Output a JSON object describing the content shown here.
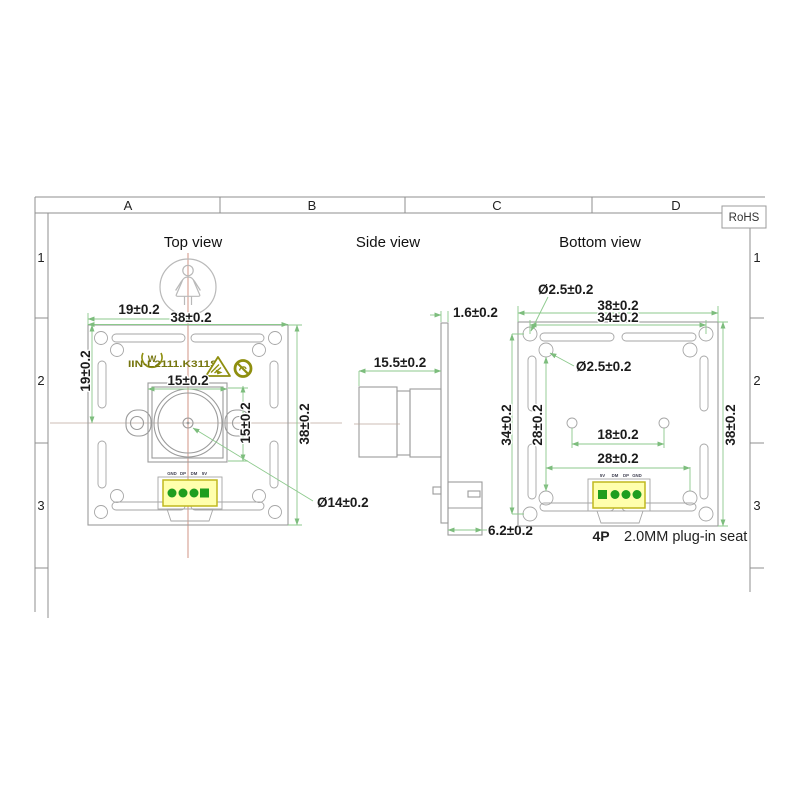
{
  "frame": {
    "columns": [
      "A",
      "B",
      "C",
      "D"
    ],
    "rows": [
      "1",
      "2",
      "3"
    ],
    "rohs": "RoHS"
  },
  "top_view": {
    "title": "Top view",
    "board_marking": "IIN-L2111.K311S",
    "pins": [
      "GND",
      "DP",
      "DM",
      "5V"
    ],
    "dim_half_width": "19±0.2",
    "dim_width": "38±0.2",
    "dim_half_height": "19±0.2",
    "dim_height": "38±0.2",
    "dim_lens_width": "15±0.2",
    "dim_lens_height": "15±0.2",
    "dim_lens_diameter": "Ø14±0.2"
  },
  "side_view": {
    "title": "Side view",
    "dim_board_thickness": "1.6±0.2",
    "dim_lens_length": "15.5±0.2",
    "dim_connector_depth": "6.2±0.2"
  },
  "bottom_view": {
    "title": "Bottom view",
    "pins": [
      "5V",
      "DM",
      "DP",
      "GND"
    ],
    "dim_hole_corner": "Ø2.5±0.2",
    "dim_width": "38±0.2",
    "dim_hole_span_h": "34±0.2",
    "dim_hole_inner": "Ø2.5±0.2",
    "dim_hole_span_v": "34±0.2",
    "dim_inner_span_v": "28±0.2",
    "dim_mid_holes": "18±0.2",
    "dim_inner_span_h": "28±0.2",
    "dim_height": "38±0.2",
    "connector_pins": "4P",
    "connector_note": "2.0MM plug-in seat"
  },
  "colors": {
    "dimension_line": "#8cc98c",
    "centerline_red": "#cc8878",
    "outline_gray": "#9b9b9b",
    "connector_fill": "#ffffad",
    "connector_border": "#c0b81e",
    "pin_green": "#1f9e1f",
    "silkscreen_olive": "#80800f"
  }
}
